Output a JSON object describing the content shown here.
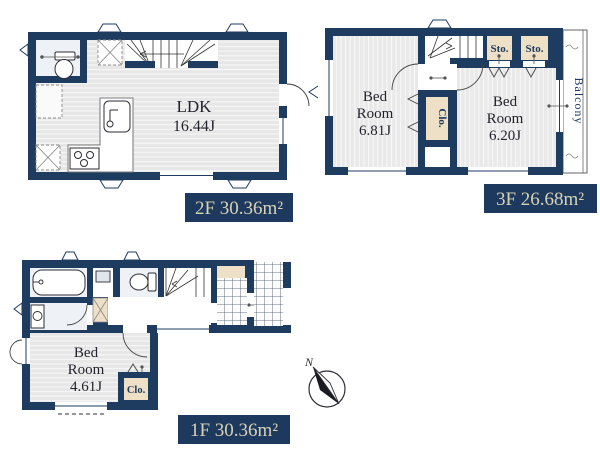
{
  "floor2": {
    "area_label": "2F 30.36m²",
    "ldk": {
      "name": "LDK",
      "size": "16.44J"
    }
  },
  "floor3": {
    "area_label": "3F 26.68m²",
    "bedroom_left": {
      "line1": "Bed",
      "line2": "Room",
      "size": "6.81J"
    },
    "bedroom_right": {
      "line1": "Bed",
      "line2": "Room",
      "size": "6.20J"
    },
    "closet_label": "Clo.",
    "storage1_label": "Sto.",
    "storage2_label": "Sto.",
    "balcony_label": "Balcony"
  },
  "floor1": {
    "area_label": "1F 30.36m²",
    "bedroom": {
      "line1": "Bed",
      "line2": "Room",
      "size": "4.61J"
    },
    "closet_label": "Clo."
  },
  "compass": {
    "north_label": "N"
  },
  "colors": {
    "wall": "#1e3b60",
    "floor_stripe": "#e8e8e8",
    "storage_tan": "#eee0c6",
    "bath_floor": "#eef2f6",
    "label_box_bg": "#1d3a5e",
    "label_text": "#d9d1b6",
    "room_text": "#23232e"
  }
}
